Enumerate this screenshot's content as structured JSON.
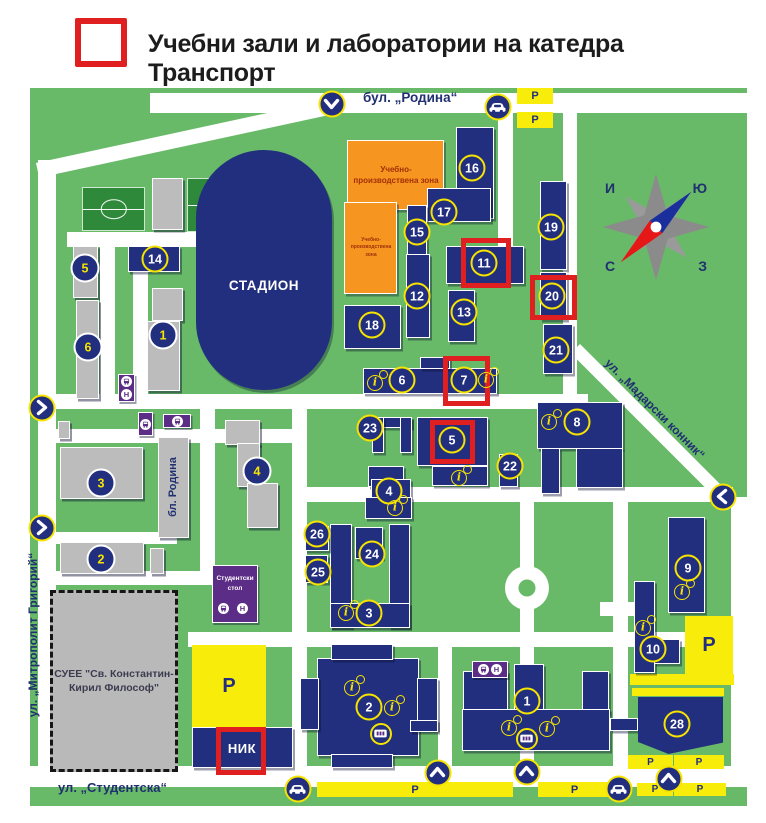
{
  "legend": {
    "title": "Учебни зали и лаборатории на катедра Транспорт",
    "highlight_color": "#e02020"
  },
  "compass": {
    "tl": "И",
    "tr": "Ю",
    "bl": "С",
    "br": "З"
  },
  "streets": {
    "rodina": "бул. „Родина“",
    "studentska": "ул. „Студентска“",
    "mitropolit": "ул. „Митрополит Григорий“",
    "madarski": "ул. „Мадарски конник“",
    "bl_rodina": "бл. Родина"
  },
  "labels": {
    "stadium": "СТАДИОН",
    "canteen_line1": "Студентски",
    "canteen_line2": "стол",
    "suee_line1": "СУЕЕ \"Св. Константин-",
    "suee_line2": "Кирил Философ\"",
    "nik": "НИК",
    "zone": "Учебно-производствена зона",
    "parking": "P"
  },
  "map": {
    "colors": {
      "ground": "#68ba68",
      "building": "#222f7e",
      "old_building": "#bcbcbc",
      "road": "#ffffff",
      "parking": "#f8ed0a",
      "zone": "#f79521",
      "transit": "#5c2d87",
      "highlight": "#e02020",
      "marker_ring_yellow": "#f6e400"
    },
    "roads": [
      [
        150,
        93,
        597,
        20
      ],
      [
        38,
        160,
        18,
        626
      ],
      [
        28,
        766,
        719,
        21
      ],
      [
        731,
        497,
        16,
        280
      ],
      [
        563,
        108,
        14,
        287
      ],
      [
        498,
        110,
        15,
        138
      ],
      [
        40,
        394,
        548,
        15
      ],
      [
        292,
        487,
        441,
        15
      ],
      [
        292,
        394,
        15,
        383
      ],
      [
        520,
        494,
        14,
        283
      ],
      [
        188,
        632,
        545,
        15
      ],
      [
        438,
        632,
        14,
        145
      ],
      [
        67,
        232,
        226,
        15
      ],
      [
        100,
        247,
        15,
        152
      ],
      [
        133,
        247,
        15,
        160
      ],
      [
        56,
        429,
        236,
        14
      ],
      [
        56,
        532,
        121,
        12
      ],
      [
        40,
        571,
        172,
        14
      ],
      [
        200,
        399,
        15,
        178
      ],
      [
        600,
        602,
        38,
        14
      ],
      [
        613,
        495,
        15,
        287
      ],
      [
        36,
        163,
        312,
        15,
        -12.2
      ],
      [
        580,
        344,
        222,
        13,
        45
      ]
    ],
    "roundabout": [
      527,
      588
    ],
    "fields": [
      [
        82,
        187,
        63,
        44
      ],
      [
        187,
        178,
        38,
        54
      ],
      [
        228,
        178,
        45,
        54
      ]
    ],
    "buildings_navy": [
      [
        456,
        127,
        38,
        92
      ],
      [
        427,
        188,
        64,
        34
      ],
      [
        407,
        205,
        20,
        52
      ],
      [
        446,
        246,
        78,
        38
      ],
      [
        406,
        254,
        24,
        84
      ],
      [
        448,
        290,
        27,
        52
      ],
      [
        344,
        305,
        57,
        44
      ],
      [
        540,
        181,
        27,
        89
      ],
      [
        540,
        272,
        27,
        48
      ],
      [
        543,
        324,
        30,
        50
      ],
      [
        363,
        368,
        134,
        26
      ],
      [
        420,
        357,
        30,
        12
      ],
      [
        372,
        417,
        40,
        11
      ],
      [
        372,
        417,
        12,
        36
      ],
      [
        400,
        417,
        12,
        36
      ],
      [
        368,
        466,
        36,
        21
      ],
      [
        371,
        479,
        40,
        19
      ],
      [
        365,
        497,
        47,
        22
      ],
      [
        417,
        417,
        71,
        49
      ],
      [
        432,
        466,
        56,
        20
      ],
      [
        499,
        454,
        19,
        33
      ],
      [
        537,
        402,
        86,
        47
      ],
      [
        541,
        448,
        19,
        46
      ],
      [
        576,
        448,
        47,
        40
      ],
      [
        668,
        517,
        37,
        96
      ],
      [
        634,
        581,
        21,
        92
      ],
      [
        654,
        639,
        26,
        25
      ],
      [
        330,
        524,
        22,
        104
      ],
      [
        389,
        524,
        21,
        104
      ],
      [
        330,
        603,
        80,
        25
      ],
      [
        355,
        527,
        28,
        32
      ],
      [
        305,
        526,
        24,
        25
      ],
      [
        305,
        555,
        23,
        28
      ],
      [
        317,
        658,
        102,
        98
      ],
      [
        331,
        644,
        62,
        16
      ],
      [
        331,
        754,
        62,
        14
      ],
      [
        300,
        678,
        19,
        52
      ],
      [
        417,
        678,
        21,
        52
      ],
      [
        463,
        671,
        45,
        42
      ],
      [
        514,
        664,
        30,
        49
      ],
      [
        582,
        671,
        27,
        42
      ],
      [
        462,
        709,
        148,
        42
      ],
      [
        192,
        727,
        101,
        41
      ],
      [
        410,
        720,
        28,
        12
      ],
      [
        610,
        718,
        28,
        13
      ],
      [
        128,
        246,
        52,
        26
      ]
    ],
    "building_28": {
      "x": 638,
      "y": 697,
      "w": 85,
      "h": 57,
      "clip": "polygon(0% 0%,100% 0%,100% 80%,36% 100%,0% 79%)"
    },
    "buildings_gray": [
      [
        73,
        246,
        25,
        52
      ],
      [
        76,
        300,
        23,
        99
      ],
      [
        152,
        288,
        31,
        33
      ],
      [
        147,
        321,
        33,
        70
      ],
      [
        60,
        447,
        83,
        52
      ],
      [
        58,
        421,
        12,
        18
      ],
      [
        60,
        542,
        84,
        32
      ],
      [
        150,
        548,
        14,
        26
      ],
      [
        158,
        437,
        31,
        101
      ],
      [
        225,
        420,
        35,
        25
      ],
      [
        237,
        443,
        23,
        44
      ],
      [
        247,
        483,
        31,
        45
      ],
      [
        152,
        178,
        31,
        52
      ]
    ],
    "zones": [
      [
        347,
        140,
        97,
        70,
        8
      ],
      [
        344,
        202,
        53,
        92,
        5
      ]
    ],
    "parkings": [
      [
        517,
        88,
        36,
        16,
        1
      ],
      [
        517,
        112,
        36,
        16,
        1
      ],
      [
        192,
        645,
        74,
        82,
        1
      ],
      [
        685,
        616,
        48,
        58,
        1
      ],
      [
        630,
        674,
        104,
        11,
        0
      ],
      [
        632,
        688,
        92,
        8,
        0
      ],
      [
        317,
        782,
        196,
        15,
        1
      ],
      [
        538,
        782,
        73,
        15,
        1
      ],
      [
        628,
        755,
        45,
        14,
        1
      ],
      [
        674,
        755,
        50,
        14,
        1
      ],
      [
        637,
        783,
        36,
        13,
        1
      ],
      [
        674,
        783,
        52,
        13,
        1
      ]
    ],
    "red_boxes": [
      [
        461,
        238,
        50,
        50
      ],
      [
        530,
        275,
        47,
        45
      ],
      [
        443,
        356,
        47,
        50
      ],
      [
        430,
        420,
        45,
        44
      ],
      [
        216,
        727,
        50,
        48
      ]
    ],
    "markers": [
      [
        5,
        85,
        268,
        1
      ],
      [
        6,
        88,
        347,
        1
      ],
      [
        1,
        163,
        335,
        1
      ],
      [
        3,
        101,
        483,
        1
      ],
      [
        2,
        101,
        559,
        1
      ],
      [
        4,
        257,
        471,
        1
      ],
      [
        14,
        155,
        259,
        0
      ],
      [
        16,
        472,
        168,
        0
      ],
      [
        17,
        444,
        212,
        0
      ],
      [
        15,
        417,
        232,
        0
      ],
      [
        11,
        484,
        263,
        0
      ],
      [
        12,
        417,
        296,
        0
      ],
      [
        13,
        464,
        312,
        0
      ],
      [
        18,
        372,
        325,
        0
      ],
      [
        19,
        551,
        227,
        0
      ],
      [
        20,
        552,
        296,
        0
      ],
      [
        21,
        556,
        350,
        0
      ],
      [
        6,
        402,
        380,
        0
      ],
      [
        7,
        464,
        380,
        0
      ],
      [
        23,
        370,
        428,
        0
      ],
      [
        5,
        452,
        440,
        0
      ],
      [
        22,
        510,
        466,
        0
      ],
      [
        4,
        389,
        491,
        0
      ],
      [
        8,
        577,
        422,
        0
      ],
      [
        26,
        317,
        534,
        0
      ],
      [
        24,
        372,
        554,
        0
      ],
      [
        25,
        318,
        572,
        0
      ],
      [
        3,
        369,
        613,
        0
      ],
      [
        9,
        688,
        568,
        0
      ],
      [
        10,
        653,
        649,
        0
      ],
      [
        2,
        369,
        707,
        0
      ],
      [
        1,
        527,
        701,
        0
      ],
      [
        28,
        677,
        724,
        0
      ]
    ],
    "info_icons": [
      [
        375,
        383
      ],
      [
        486,
        380
      ],
      [
        549,
        422
      ],
      [
        459,
        478
      ],
      [
        395,
        508
      ],
      [
        346,
        613
      ],
      [
        352,
        688
      ],
      [
        392,
        708
      ],
      [
        509,
        728
      ],
      [
        547,
        729
      ],
      [
        682,
        592
      ],
      [
        643,
        628
      ]
    ],
    "atm_icons": [
      [
        381,
        734
      ],
      [
        527,
        739
      ]
    ],
    "car_icons": [
      [
        498,
        107
      ],
      [
        298,
        789
      ],
      [
        619,
        789
      ]
    ],
    "chevrons": [
      [
        "down",
        332,
        104
      ],
      [
        "right",
        42,
        408
      ],
      [
        "right",
        42,
        528
      ],
      [
        "left",
        723,
        497
      ],
      [
        "up",
        438,
        773
      ],
      [
        "up",
        527,
        772
      ],
      [
        "up",
        669,
        779
      ]
    ],
    "bus_stops": [
      {
        "x": 118,
        "y": 374,
        "w": 17,
        "h": 28,
        "icons": [
          "bus",
          "h"
        ],
        "v": 1
      },
      {
        "x": 138,
        "y": 412,
        "w": 15,
        "h": 24,
        "icons": [
          "bus"
        ],
        "v": 0
      },
      {
        "x": 163,
        "y": 414,
        "w": 28,
        "h": 14,
        "icons": [
          "bus"
        ],
        "v": 0
      },
      {
        "x": 472,
        "y": 661,
        "w": 36,
        "h": 17,
        "icons": [
          "bus",
          "h"
        ],
        "v": 0
      }
    ],
    "canteen_icons": [
      [
        "bus",
        224,
        609
      ],
      [
        "h",
        243,
        609
      ]
    ]
  }
}
